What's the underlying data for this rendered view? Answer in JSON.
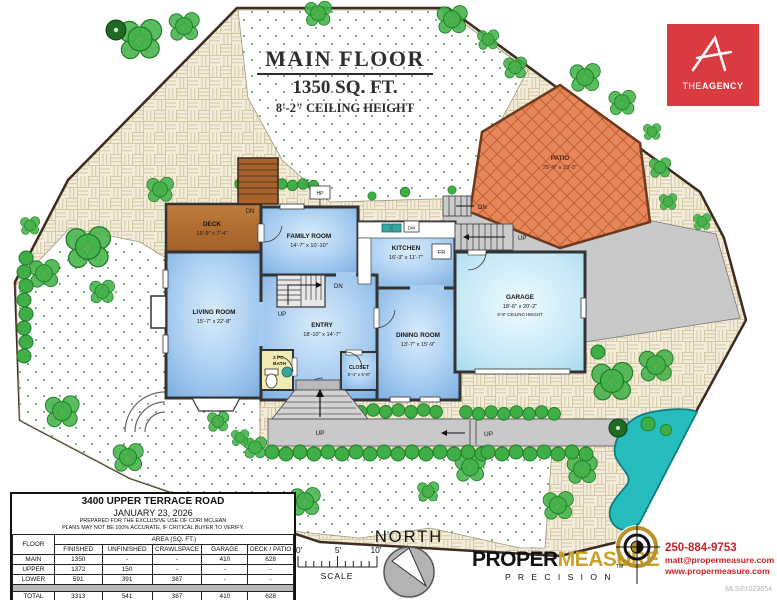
{
  "palette": {
    "room_blue": "#8fbbe9",
    "garage_blue": "#bfe4f4",
    "deck_brown": "#b06a2e",
    "patio_brick": "#e68659",
    "pool_teal": "#27bdbd",
    "agency_red": "#d93b40",
    "measure_gold": "#c9a227",
    "contact_red": "#cc2127",
    "wall": "#333333"
  },
  "title": {
    "line1": "MAIN FLOOR",
    "line2": "1350 SQ. FT.",
    "line3": "8'-2\" CEILING HEIGHT"
  },
  "agency": {
    "the": "THE",
    "agency": "AGENCY"
  },
  "rooms": {
    "deck": {
      "name": "DECK",
      "dims": "15'-9\" x 7'-4\""
    },
    "family_room": {
      "name": "FAMILY ROOM",
      "dims": "14'-7\" x 10'-10\""
    },
    "kitchen": {
      "name": "KITCHEN",
      "dims": "16'-3\" x 11'-7\""
    },
    "living_room": {
      "name": "LIVING ROOM",
      "dims": "15'-7\" x 22'-8\""
    },
    "entry": {
      "name": "ENTRY",
      "dims": "18'-10\" x 14'-7\""
    },
    "dining_room": {
      "name": "DINING ROOM",
      "dims": "13'-7\" x 15'-9\""
    },
    "closet": {
      "name": "CLOSET",
      "dims": "5'-4\" x 5'-8\""
    },
    "bath": {
      "name_line1": "2 PC",
      "name_line2": "BATH"
    },
    "garage": {
      "name": "GARAGE",
      "dims": "18'-6\" x 20'-2\"",
      "ceiling": "8'-8\" CEILING HEIGHT"
    },
    "patio": {
      "name": "PATIO",
      "dims": "25'-9\" x 23'-5\""
    }
  },
  "plan_labels": {
    "up": "UP",
    "dn": "DN",
    "hp": "HP",
    "dw": "DW",
    "fr": "FR"
  },
  "info_table": {
    "address": "3400 UPPER TERRACE ROAD",
    "date": "JANUARY 23, 2026",
    "note1": "PREPARED FOR THE EXCLUSIVE USE OF CORI MCLEAN",
    "note2": "PLANS MAY NOT BE 100% ACCURATE, IF CRITICAL BUYER TO VERIFY.",
    "col_floor": "FLOOR",
    "area_header": "AREA (SQ. FT.)",
    "columns": [
      "FINISHED",
      "UNFINISHED",
      "CRAWLSPACE",
      "GARAGE",
      "DECK / PATIO"
    ],
    "rows": [
      {
        "floor": "MAIN",
        "values": [
          "1350",
          "-",
          "-",
          "410",
          "628"
        ]
      },
      {
        "floor": "UPPER",
        "values": [
          "1372",
          "150",
          "-",
          "-",
          "-"
        ]
      },
      {
        "floor": "LOWER",
        "values": [
          "591",
          "391",
          "387",
          "-",
          "-"
        ]
      },
      {
        "floor": "TOTAL",
        "values": [
          "3313",
          "541",
          "387",
          "410",
          "628"
        ]
      }
    ]
  },
  "compass": {
    "label": "NORTH"
  },
  "scale_bar": {
    "zero": "0'",
    "five": "5'",
    "ten": "10'",
    "label": "SCALE"
  },
  "branding": {
    "proper": "PROPER",
    "measure": "MEASURE",
    "tm": "TM",
    "precision": "P R E C I S I O N",
    "phone": "250-884-9753",
    "email": "matt@propermeasure.com",
    "website": "www.propermeasure.com"
  },
  "mls": "MLS®1023654"
}
